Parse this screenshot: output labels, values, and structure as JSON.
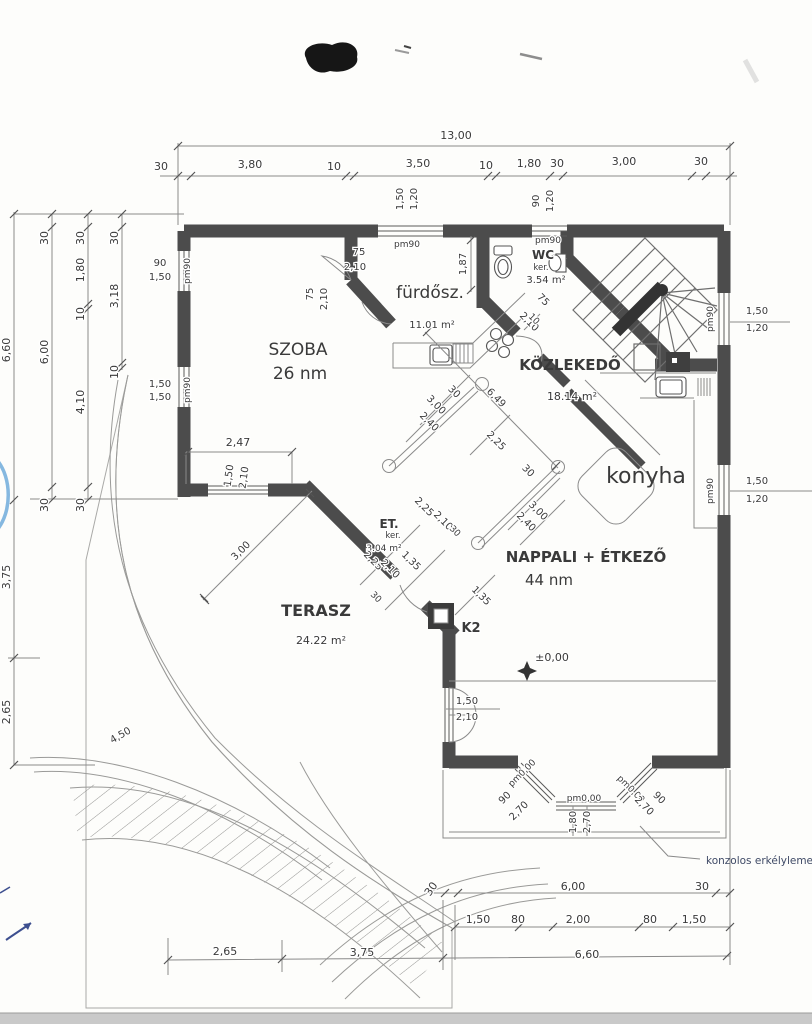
{
  "rooms": {
    "szoba": {
      "name": "SZOBA",
      "area": "26 nm"
    },
    "furdo": {
      "name": "fürdősz.",
      "area": "11.01 m²"
    },
    "wc": {
      "name": "WC",
      "type": "ker.",
      "area": "3.54 m²",
      "pm": "pm90"
    },
    "kozlekedo": {
      "name": "KÖZLEKEDŐ",
      "area": "18.14 m²"
    },
    "konyha": {
      "name": "konyha"
    },
    "nappali": {
      "name": "NAPPALI + ÉTKEZŐ",
      "area": "44 nm"
    },
    "terasz": {
      "name": "TERASZ",
      "area": "24.22 m²"
    },
    "eloter": {
      "name": "ET.",
      "type": "ker.",
      "area": "3.04 m²"
    }
  },
  "annotations": {
    "k2": "K2",
    "level": "±0,00",
    "balcony_note": "konzolos erkélylemez!"
  },
  "dim_top": {
    "total": "13,00",
    "d1": "30",
    "d2": "3,80",
    "d3": "10",
    "d4": "3,50",
    "d5": "10",
    "d6": "1,80",
    "d7": "30",
    "d8": "3,00",
    "d9": "30"
  },
  "dim_left": {
    "total": "6,60",
    "a1": "30",
    "a2": "6,00",
    "a3": "30",
    "b1": "30",
    "b2": "1,80",
    "b3": "10",
    "b4": "4,10",
    "b5": "30",
    "c1": "30",
    "c2": "3,18",
    "c3": "10",
    "low1": "3,75",
    "low2": "2,65"
  },
  "dim_bottom": {
    "a1": "30",
    "a2": "6,00",
    "a3": "30",
    "b1": "1,50",
    "b2": "80",
    "b3": "2,00",
    "b4": "80",
    "b5": "1,50",
    "c1": "2,65",
    "c2": "3,75",
    "c3": "6,60"
  },
  "dim_diag": {
    "k1": "30",
    "k2": "3,00",
    "k3": "2,40",
    "len": "6,49",
    "k4": "2,25",
    "k5": "30",
    "k6": "3,00",
    "k7": "2,40",
    "k8": "10",
    "terasz": "3,00",
    "ramp": "4,50",
    "v187": "1,87"
  },
  "dim_et": {
    "e1": "2,25",
    "e2": "2,10",
    "e3": "30",
    "e4": "2,25",
    "e5": "2,10",
    "e6": "1,35",
    "e7": "30",
    "e8": "1,35"
  },
  "windows": {
    "top_left": {
      "w": "1,50",
      "h": "1,20",
      "pm": "pm90"
    },
    "top_right": {
      "w": "90",
      "h": "1,20",
      "pm": "pm90"
    },
    "left_upper": {
      "w": "90",
      "h": "1,50",
      "pm": "pm90"
    },
    "left_lower": {
      "w": "1,50",
      "h": "1,50",
      "pm": "pm90"
    },
    "right_upper": {
      "w": "1,50",
      "h": "1,20",
      "pm": "pm90"
    },
    "right_lower": {
      "w": "1,50",
      "h": "1,20",
      "pm": "pm90"
    },
    "szoba_south": {
      "w": "1,50",
      "h": "2,10",
      "dim": "2,47"
    },
    "terasz_door": {
      "w": "1,50",
      "h": "2,10"
    },
    "bay_left": {
      "w": "90",
      "h": "2,70",
      "pm": "pm0,00"
    },
    "bay_center": {
      "w": "1,80",
      "h": "2,70",
      "pm": "pm0,00"
    },
    "bay_right": {
      "w": "2,70",
      "h": "90",
      "pm": "pm0,00"
    },
    "door_szoba": {
      "w": "75",
      "h": "2,10"
    },
    "door_furdo": {
      "w": "75",
      "h": "2,10"
    },
    "door_wc": {
      "w": "75",
      "h": "2,10"
    }
  }
}
